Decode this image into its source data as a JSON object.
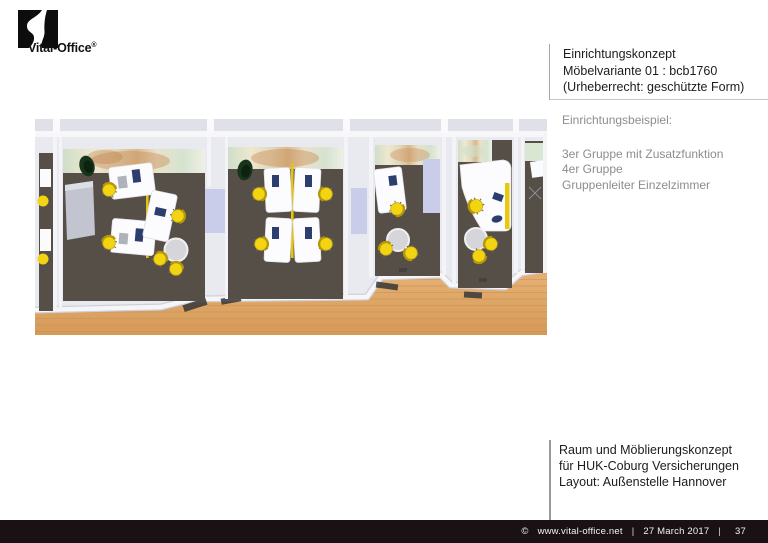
{
  "logo": {
    "brand": "Vital-Office",
    "registered": "®"
  },
  "header_block": {
    "line1": "Einrichtungskonzept",
    "line2": "Möbelvariante 01 : bcb1760",
    "line3": "(Urheberrecht: geschützte Form)"
  },
  "example_block": {
    "title": "Einrichtungsbeispiel:",
    "items": [
      "3er Gruppe mit Zusatzfunktion",
      "4er Gruppe",
      "Gruppenleiter Einzelzimmer"
    ]
  },
  "project_block": {
    "line1": "Raum und Möblierungskonzept",
    "line2": "für HUK-Coburg Versicherungen",
    "line3": "Layout: Außenstelle Hannover"
  },
  "footer": {
    "copyright": "©",
    "website": "www.vital-office.net",
    "separator": "|",
    "date": "27 March 2017",
    "page_number": "37"
  },
  "floor_plan": {
    "description": "3D top-down rendering of four office rooms: 3er Gruppe mit Zusatzfunktion, 4er Gruppe, Zusatzraum and Gruppenleiter Einzelzimmer, with white desks, yellow swivel chairs, plants, sideboards, round tables and a wooden corridor floor",
    "colors": {
      "carpet": "#564f48",
      "wood_floor": "#dfa768",
      "wall_light": "#e9eaef",
      "wall_white": "#f7f7fa",
      "chair_yellow": "#f2d412",
      "divider_yellow": "#e3c40f",
      "cabinet_lavender": "#c9cde9",
      "cabinet_gray": "#c2c5cf",
      "desk_white": "#fcfcfe",
      "accessory_navy": "#2c3e6e",
      "plant_green": "#18351c",
      "table_gray": "#d6d6da"
    }
  }
}
